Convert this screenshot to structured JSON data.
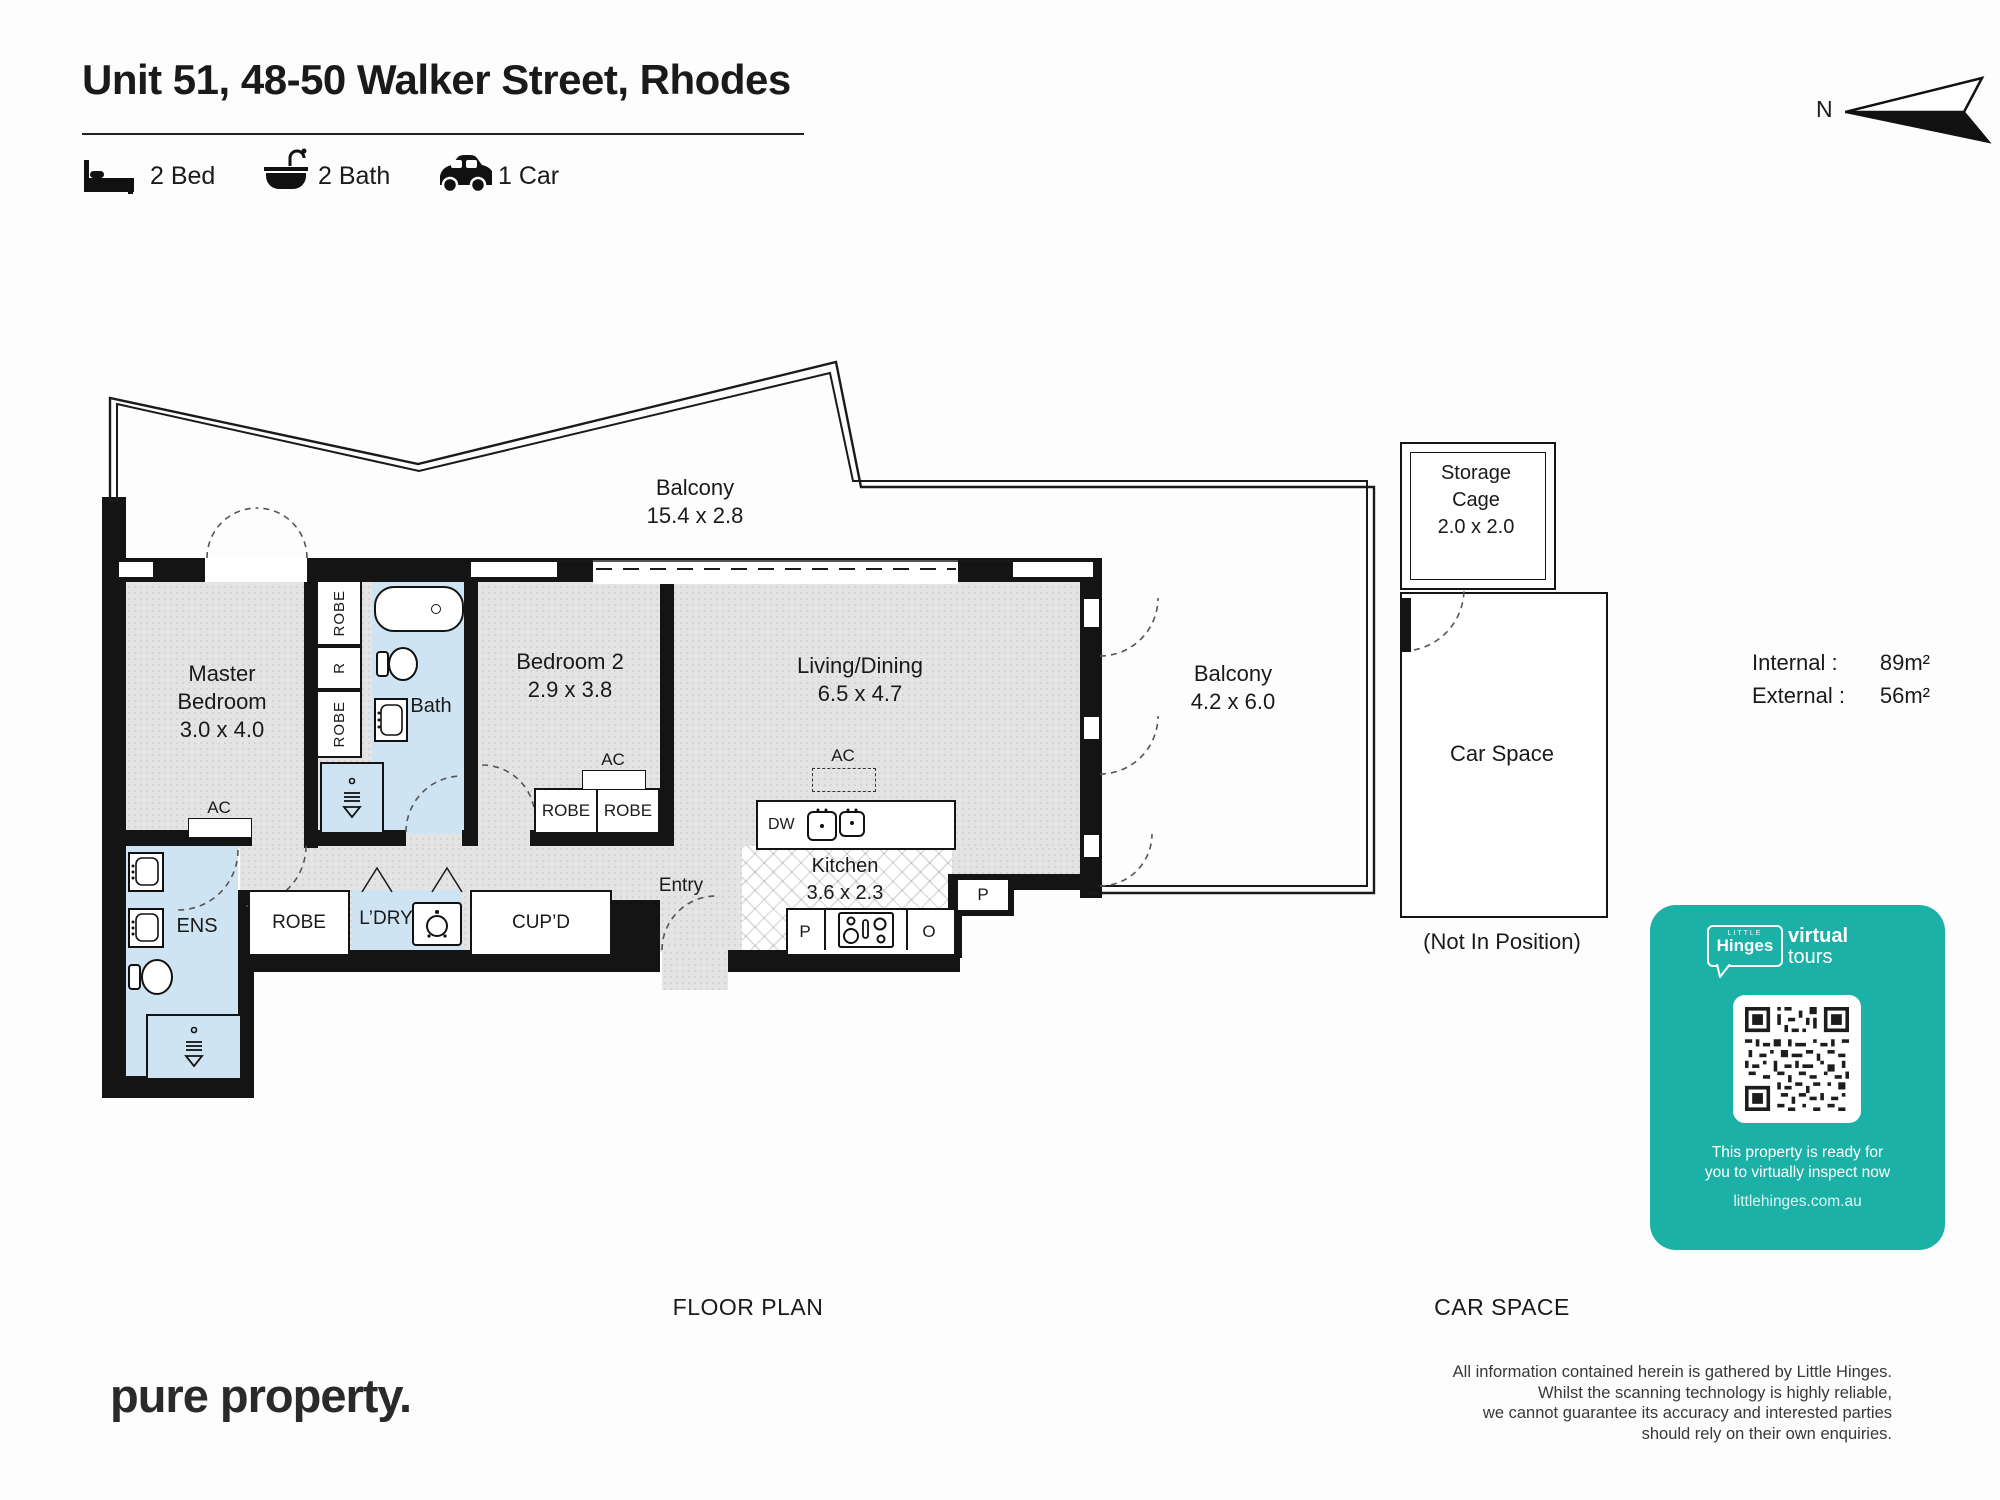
{
  "header": {
    "title": "Unit 51, 48-50 Walker Street, Rhodes",
    "bed_label": "2 Bed",
    "bath_label": "2 Bath",
    "car_label": "1 Car",
    "north": "N"
  },
  "plan": {
    "balcony_top": {
      "label": "Balcony",
      "dims": "15.4 x 2.8"
    },
    "balcony_right": {
      "label": "Balcony",
      "dims": "4.2 x 6.0"
    },
    "master": {
      "line1": "Master",
      "line2": "Bedroom",
      "dims": "3.0 x 4.0"
    },
    "bedroom2": {
      "label": "Bedroom 2",
      "dims": "2.9 x 3.8"
    },
    "living": {
      "label": "Living/Dining",
      "dims": "6.5 x 4.7"
    },
    "kitchen": {
      "label": "Kitchen",
      "dims": "3.6 x 2.3"
    },
    "bath": "Bath",
    "ens": "ENS",
    "entry": "Entry",
    "hall_robe": "ROBE",
    "ldry": "L’DRY",
    "cupd": "CUP’D",
    "robe_column": [
      "ROBE",
      "R",
      "ROBE"
    ],
    "bed2_robes": [
      "ROBE",
      "ROBE"
    ],
    "ac": "AC",
    "dw": "DW",
    "pantry": "P",
    "oven": "O",
    "p2": "P"
  },
  "storage": {
    "line1": "Storage",
    "line2": "Cage",
    "dims": "2.0 x 2.0"
  },
  "car_space": {
    "label": "Car Space",
    "note": "(Not In Position)"
  },
  "areas": {
    "internal_label": "Internal :",
    "internal_value": "89m²",
    "external_label": "External :",
    "external_value": "56m²"
  },
  "captions": {
    "left": "FLOOR PLAN",
    "right": "CAR SPACE"
  },
  "promo": {
    "little": "LITTLE",
    "hinges": "Hinges",
    "virtual": "virtual",
    "tours": "tours",
    "line1": "This property is ready for",
    "line2": "you to virtually inspect now",
    "url": "littlehinges.com.au",
    "teal": "#1BB1A7"
  },
  "footer": {
    "brand": "pure property.",
    "disclaimer": [
      "All information contained herein is gathered by Little Hinges.",
      "Whilst the scanning technology is highly reliable,",
      "we cannot guarantee its accuracy and interested parties",
      "should rely on their own enquiries."
    ]
  }
}
